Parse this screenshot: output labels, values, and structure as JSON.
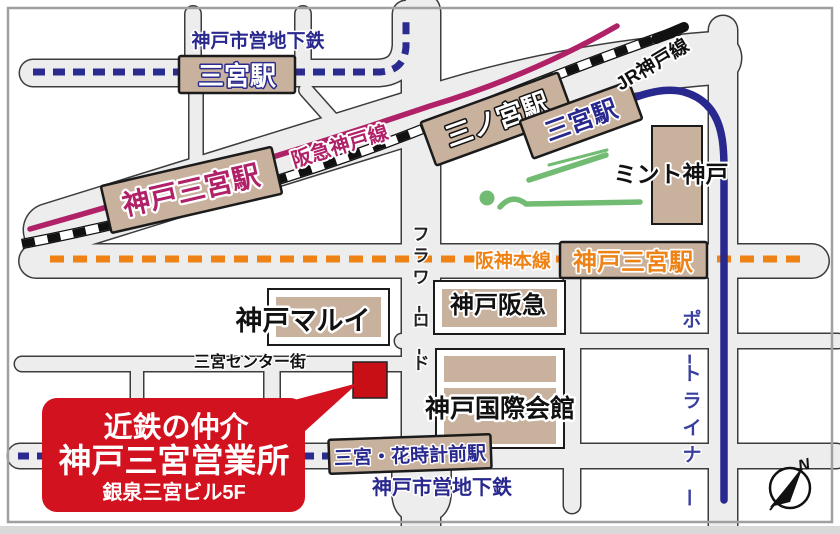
{
  "colors": {
    "accent_red": "#d2121f",
    "marker_red": "#c90f16",
    "subway_navy": "#2b2b8f",
    "portliner_navy": "#28288f",
    "hankyu_magenta": "#b02168",
    "hanshin_orange": "#ee8215",
    "jr_black": "#111111",
    "road_gray": "#ededed",
    "building_tan": "#c8b19d",
    "park_green": "#72bb72"
  },
  "lines": {
    "subway_top": "神戸市営地下鉄",
    "subway_bottom": "神戸市営地下鉄",
    "hankyu": "阪急神戸線",
    "jr": "JR神戸線",
    "hanshin": "阪神本線",
    "portliner": "ポートライナー"
  },
  "roads": {
    "flower_road": "フラワーロード",
    "center_street": "三宮センター街"
  },
  "stations": {
    "subway_sannomiya": "三宮駅",
    "hankyu_kobe_sannomiya": "神戸三宮駅",
    "jr_sannomiya": "三ノ宮駅",
    "portliner_sannomiya": "三宮駅",
    "hanshin_kobe_sannomiya": "神戸三宮駅",
    "subway_hanadokei_mae": "三宮・花時計前駅"
  },
  "buildings": {
    "mint_kobe": "ミント神戸",
    "kobe_marui": "神戸マルイ",
    "kobe_hankyu": "神戸阪急",
    "kobe_international_house": "神戸国際会館"
  },
  "callout": {
    "line1": "近鉄の仲介",
    "line2": "神戸三宮営業所",
    "line3": "銀泉三宮ビル5F"
  },
  "compass": {
    "north": "N"
  }
}
